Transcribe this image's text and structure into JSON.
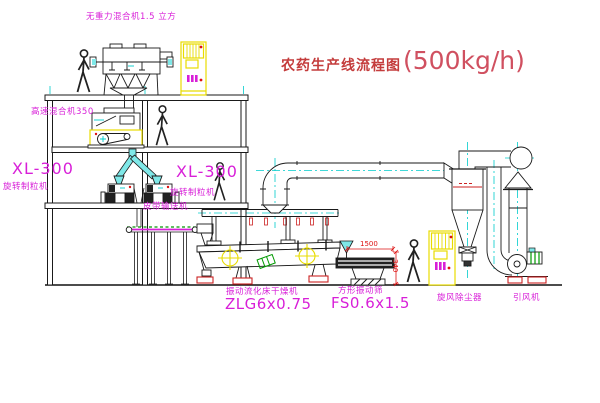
{
  "title": {
    "text": "农药生产线流程图",
    "capacity": "(500kg/h)"
  },
  "equipment": {
    "gravity_mixer": {
      "label": "无重力混合机1.5 立方"
    },
    "high_speed_mixer": {
      "label": "高速混合机350"
    },
    "granulator_left": {
      "model": "XL-300",
      "name": "旋转制粒机"
    },
    "granulator_right": {
      "model": "XL-300",
      "name": "旋转制粒机"
    },
    "belt_conveyor": {
      "label": "皮带输送机"
    },
    "fluid_bed_dryer": {
      "name": "振动流化床干燥机",
      "model": "ZLG6x0.75"
    },
    "vibrating_screen": {
      "name": "方形振动筛",
      "model": "FS0.6x1.5",
      "dim_width": "1500",
      "dim_height": "340"
    },
    "cyclone": {
      "label": "旋风除尘器"
    },
    "fan": {
      "label": "引风机"
    }
  },
  "colors": {
    "background": "#ffffff",
    "line_black": "#1a1a1a",
    "label_magenta": "#d81fd8",
    "title_red": "#c43c3c",
    "cad_cyan": "#00cccc",
    "cad_yellow": "#e8dc00",
    "cad_green": "#009900",
    "dim_red": "#dd1111"
  }
}
